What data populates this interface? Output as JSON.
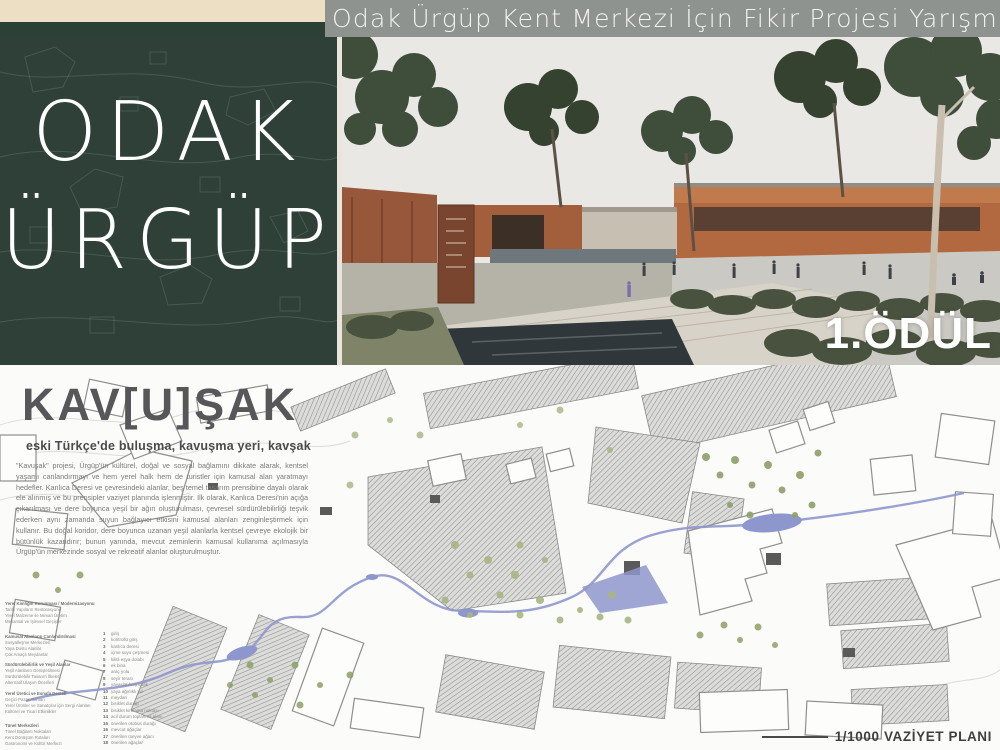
{
  "header": {
    "competition_title": "Odak Ürgüp Kent Merkezi İçin Fikir Projesi Yarışması"
  },
  "brand": {
    "line1": "ODAK",
    "line2": "ÜRGÜP"
  },
  "render": {
    "award_label": "1.ÖDÜL"
  },
  "project": {
    "title": "KAV[U]ŞAK",
    "subtitle": "eski Türkçe'de buluşma, kavuşma yeri, kavşak",
    "description": "\"Kavuşak\" projesi, Ürgüp'ün kültürel, doğal ve sosyal bağlamını dikkate alarak, kentsel yaşamı canlandırmayı ve hem yerel halk hem de turistler için kamusal alan yaratmayı hedefler. Kanlıca Deresi ve çevresindeki alanlar, beş temel tasarım prensibine dayalı olarak ele alınmış ve bu prensipler vaziyet planında işlenmiştir. İlk olarak, Kanlıca Deresi'nin açığa çıkarılması ve dere boyunca yeşil bir ağın oluşturulması, çevresel sürdürülebilirliği teşvik ederken aynı zamanda suyun bağlayıcı etkisini kamusal alanları zenginleştirmek için kullanır. Bu doğal koridor, dere boyunca uzanan yeşil alanlarla kentsel çevreye ekolojik bir bütünlük kazandırır; bunun yanında, mevcut zeminlerin kamusal kullanıma açılmasıyla Ürgüp'ün merkezinde sosyal ve rekreatif alanlar oluşturulmuştur."
  },
  "legend": {
    "principle_groups": [
      {
        "lines": [
          "Yerel Kimliğin Korunması / Modernizasyonu",
          "Tarihi Yapıların Restorasyonu",
          "Yerel Malzeme ile Mimari Üretim",
          "Mekansal ve İşlevsel Geçişler"
        ]
      },
      {
        "lines": [
          "Kamusal Alanların Canlandırılması",
          "Sosyalleşme Merkezleri",
          "Yaya Dostu Alanlar",
          "Çok Amaçlı Meydanlar"
        ]
      },
      {
        "lines": [
          "Sürdürülebilirlik ve Yeşil Alanlar",
          "Yeşil Alanların Genişletilmesi",
          "Sürdürülebilir Tasarım İlkeleri",
          "Alternatif Ulaşım Önerileri"
        ]
      },
      {
        "lines": [
          "Yerel Üretici ve Esnafa Destek",
          "Geçici Pazar Alanları",
          "Yerel Ürünler ve Sanatçılar için Sergi Alanları",
          "Kültürel ve Ticari Etkinlikler"
        ]
      },
      {
        "lines": [
          "Tünel Merkezleri",
          "Tünel Bağlantı Noktaları",
          "Kent Dönüşüm Rotaları",
          "Gastronomi ve Kültür Merkezi"
        ]
      }
    ],
    "map_items": [
      {
        "num": "1",
        "label": "giriş"
      },
      {
        "num": "2",
        "label": "kontrollü giriş"
      },
      {
        "num": "3",
        "label": "kanlıca deresi"
      },
      {
        "num": "4",
        "label": "içme suyu çeşmesi"
      },
      {
        "num": "5",
        "label": "kilitli eşya dolabı"
      },
      {
        "num": "6",
        "label": "ek bina"
      },
      {
        "num": "7",
        "label": "araç yolu"
      },
      {
        "num": "8",
        "label": "seyir terası"
      },
      {
        "num": "9",
        "label": "yavaşlatılmış trafik"
      },
      {
        "num": "10",
        "label": "yaya ağırlıklı yol"
      },
      {
        "num": "11",
        "label": "meydan"
      },
      {
        "num": "12",
        "label": "bisiklet durağı"
      },
      {
        "num": "13",
        "label": "bisiklet kiralama noktası"
      },
      {
        "num": "14",
        "label": "acil durum toplanma alanı"
      },
      {
        "num": "15",
        "label": "önerilen otobüs durağı"
      },
      {
        "num": "16",
        "label": "mevcut ağaçlar"
      },
      {
        "num": "17",
        "label": "önerilen meyve ağacı"
      },
      {
        "num": "18",
        "label": "önerilen ağaçlar"
      }
    ]
  },
  "plan": {
    "scale_label": "1/1000 VAZİYET PLANI"
  },
  "colors": {
    "beige_bar": "#ecdfc4",
    "header_gray": "#8e938f",
    "panel_green": "#2e4038",
    "terracotta": "#b2693f",
    "stream_blue": "#8e97cd",
    "title_gray": "#57575a"
  }
}
